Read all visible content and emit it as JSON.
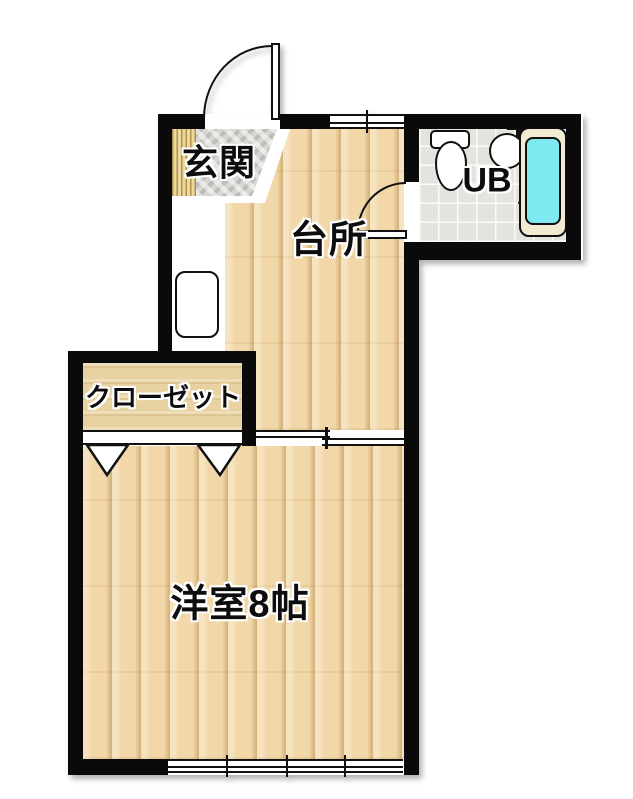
{
  "plan": {
    "title": "1K apartment floor plan",
    "rooms": {
      "genkan": {
        "label": "玄関"
      },
      "kitchen": {
        "label": "台所"
      },
      "unit_bath": {
        "label": "UB"
      },
      "closet": {
        "label": "クローゼット"
      },
      "western_room": {
        "label": "洋室8帖"
      }
    },
    "fixtures": [
      "entrance-swing-door",
      "kitchen-counter",
      "kitchen-sink",
      "ub-swing-door",
      "toilet",
      "washbasin",
      "shower-faucet",
      "bathtub",
      "closet-folding-doors",
      "sliding-door",
      "top-window",
      "bottom-window"
    ],
    "colors": {
      "wall": "#0a0a0a",
      "wood_floor": "#f2d8a8",
      "wood_plank_line": "#a6763a",
      "closet_floor": "#e9d2a2",
      "entrance_stone": "#d7d6d3",
      "entrance_slats": "#ecd9a0",
      "ub_tile": "#e4e3e0",
      "bathtub_rim": "#f1ebd2",
      "bathtub_water": "#7de9f1"
    }
  }
}
